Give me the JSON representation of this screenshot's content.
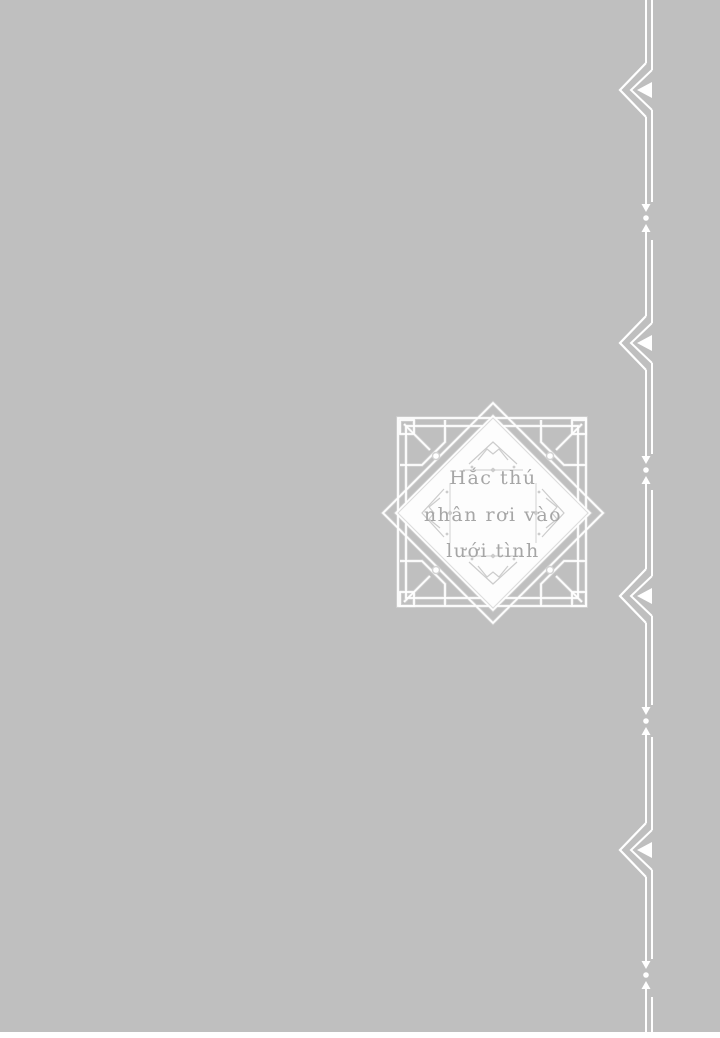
{
  "page": {
    "background_color": "#bfbfbf",
    "ornament_color": "#ffffff",
    "bottom_strip_color": "#ffffff"
  },
  "medallion": {
    "title_lines": [
      "Hắc thú",
      "nhân rơi vào",
      "lưới tình"
    ],
    "full_title": "Hắc thú nhân rơi vào lưới tình",
    "text_color": "#a6a6a6",
    "fill_color": "#fdfdfd",
    "shadow_line_color": "#d3d3d3",
    "ornament_detail_color": "#cccccc"
  },
  "icons": {
    "right_border": [
      "double-chevron-left-icon",
      "arrow-dot-arrow-icon"
    ],
    "medallion": [
      "corner-ornament-icon",
      "tip-ornament-icon"
    ]
  }
}
